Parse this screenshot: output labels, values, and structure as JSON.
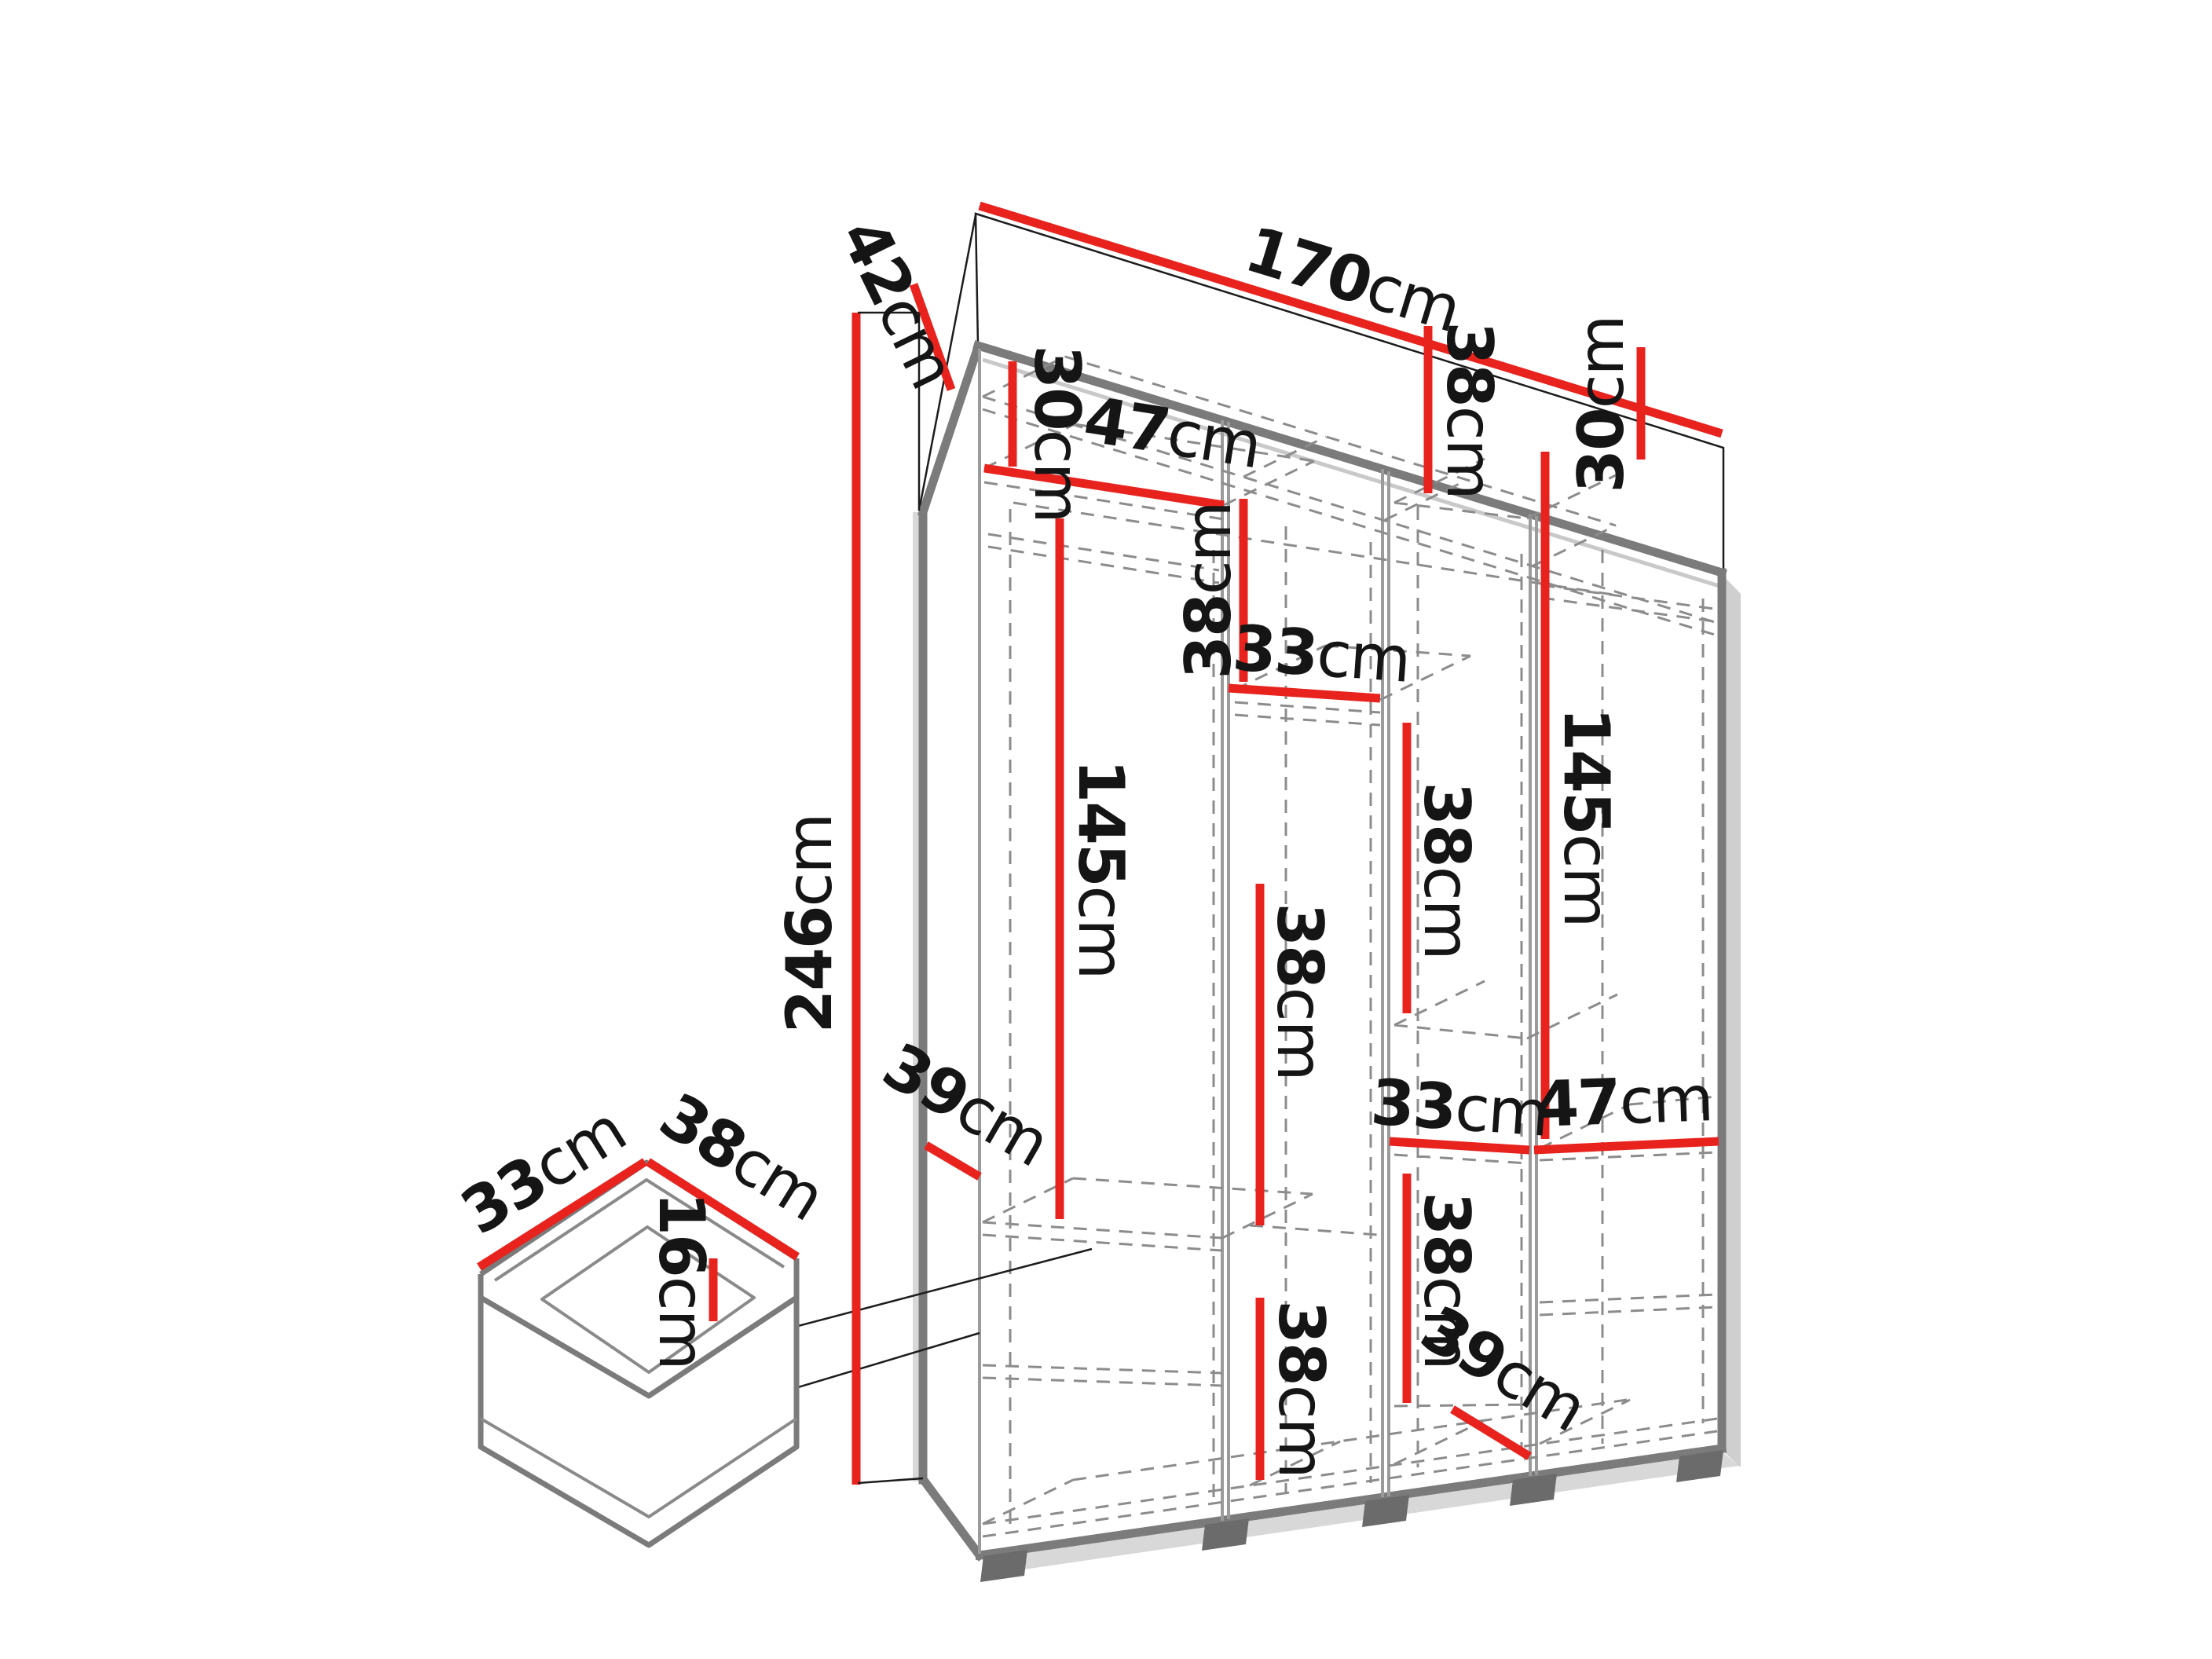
{
  "diagram": {
    "unit": "cm",
    "overall_width": "170",
    "overall_depth": "42",
    "overall_height": "246"
  },
  "labels": {
    "width_top": {
      "value": "170",
      "unit": "cm"
    },
    "depth_top": {
      "value": "42",
      "unit": "cm"
    },
    "height_left": {
      "value": "246",
      "unit": "cm"
    },
    "col1_top_height": {
      "value": "30",
      "unit": "cm"
    },
    "col1_shelf_width": {
      "value": "47",
      "unit": "cm"
    },
    "col1_hanging_height": {
      "value": "145",
      "unit": "cm"
    },
    "col2_top_height": {
      "value": "38",
      "unit": "cm"
    },
    "col2_shelf_width": {
      "value": "33",
      "unit": "cm"
    },
    "col3_top_height": {
      "value": "38",
      "unit": "cm"
    },
    "col4_top_height": {
      "value": "30",
      "unit": "cm"
    },
    "col3_mid_height": {
      "value": "38",
      "unit": "cm"
    },
    "col4_hanging_height": {
      "value": "145",
      "unit": "cm"
    },
    "col2_mid_height": {
      "value": "38",
      "unit": "cm"
    },
    "col3_shelf_width": {
      "value": "33",
      "unit": "cm"
    },
    "col3_low_height": {
      "value": "38",
      "unit": "cm"
    },
    "col4_shelf_width": {
      "value": "47",
      "unit": "cm"
    },
    "left_shelf_depth": {
      "value": "39",
      "unit": "cm"
    },
    "col2_bottom_height": {
      "value": "38",
      "unit": "cm"
    },
    "col4_bottom_depth": {
      "value": "39",
      "unit": "cm"
    },
    "drawer_width": {
      "value": "33",
      "unit": "cm"
    },
    "drawer_depth": {
      "value": "38",
      "unit": "cm"
    },
    "drawer_height": {
      "value": "16",
      "unit": "cm"
    }
  }
}
